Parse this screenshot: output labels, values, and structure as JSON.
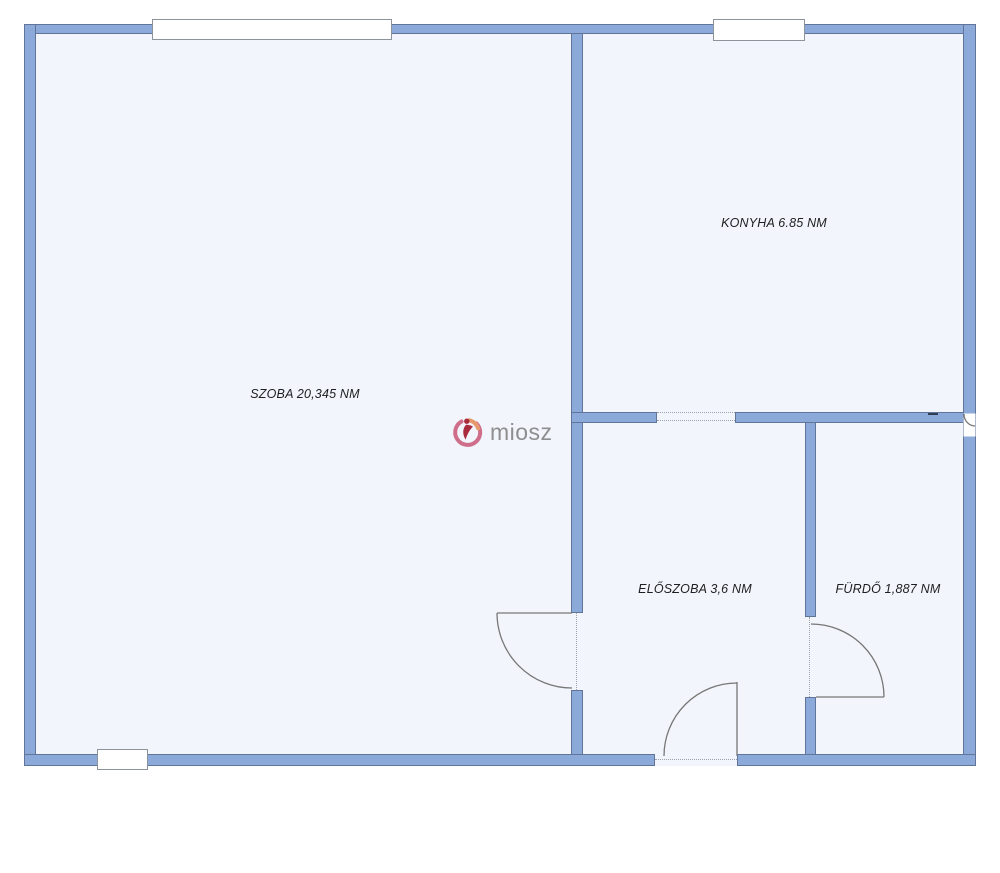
{
  "page": {
    "type": "apartment floor plan"
  },
  "colors": {
    "page_bg": "#ffffff",
    "wall_fill": "#8caad9",
    "wall_border": "#61759b",
    "room_fill": "#f2f5fb",
    "room_border": "#4f658c",
    "door_line": "#777777",
    "dotted_line": "#9aa2ac",
    "label_color": "#1d1e20",
    "window_fill": "#ffffff",
    "window_border": "#8d939b",
    "logo_text_color": "#8e8e90",
    "logo_pink": "#cf6e8b",
    "logo_red": "#a92c3e",
    "logo_orange": "#e79a6d"
  },
  "rooms": [
    {
      "name": "szoba",
      "label": "SZOBA 20,345 NM",
      "area": "20,345 NM"
    },
    {
      "name": "konyha",
      "label": "KONYHA 6.85 NM",
      "area": "6.85 NM"
    },
    {
      "name": "eloszoba",
      "label": "ELŐSZOBA 3,6 NM",
      "area": "3,6 NM"
    },
    {
      "name": "furdo",
      "label": "FÜRDŐ 1,887 NM",
      "area": "1,887 NM"
    }
  ],
  "watermark": {
    "text": "miosz"
  }
}
